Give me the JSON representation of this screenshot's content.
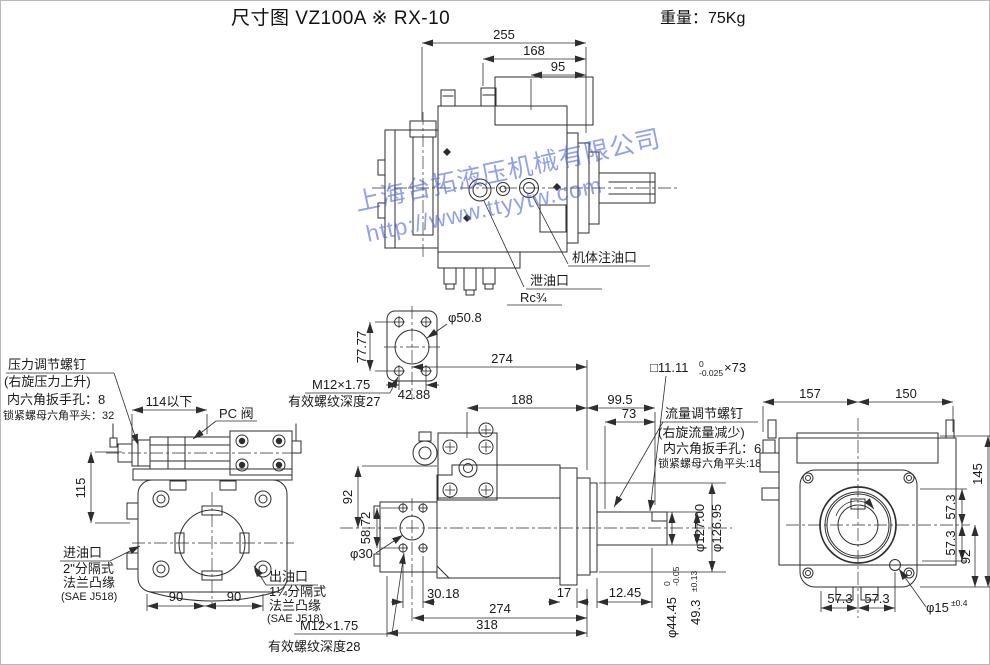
{
  "header": {
    "title": "尺寸图  VZ100A ※ RX-10",
    "weight": "重量：75Kg"
  },
  "watermark": {
    "line1": "上海台拓液压机械有限公司",
    "line2": "http://www.ttyytw.com"
  },
  "top_view": {
    "d255": "255",
    "d168": "168",
    "d95": "95",
    "fill_port": "机体注油口",
    "drain_port": "泄油口",
    "drain_thread": "Rc¾"
  },
  "pressure_screw": {
    "title": "压力调节螺钉",
    "note": "(右旋压力上升)",
    "hex_hole": "内六角扳手孔：8",
    "lock_nut": "锁紧螺母六角平头：32"
  },
  "flange_detail": {
    "d7777": "77.77",
    "dia": "φ50.8",
    "d4288": "42.88",
    "thread": "M12×1.75",
    "thread_depth": "有效螺纹深度27"
  },
  "left_view": {
    "d114": "114以下",
    "pc_valve": "PC 阀",
    "d115": "115",
    "d90a": "90",
    "d90b": "90",
    "inlet_l1": "进油口",
    "inlet_l2": "2\"分隔式",
    "inlet_l3": "法兰凸缘",
    "inlet_l4": "(SAE J518)",
    "outlet_l1": "出油口",
    "outlet_l2": "1¼分隔式",
    "outlet_l3": "法兰凸缘",
    "outlet_l4": "(SAE J518)"
  },
  "center_view": {
    "d274_top": "274",
    "d188": "188",
    "d99_5": "99.5",
    "d73": "73",
    "keyway": "□11.11",
    "keyway_hi": "0",
    "keyway_lo": "-0.025",
    "keyway_len": "×73",
    "d92": "92",
    "d58_72": "58.72",
    "dia30": "φ30",
    "d30_18": "30.18",
    "d274": "274",
    "d318": "318",
    "d17": "17",
    "d12_45": "12.45",
    "dia127_hi": "φ127.00",
    "dia127_lo": "φ126.95",
    "dia44": "φ44.45",
    "dia44_hi": "0",
    "dia44_lo": "-0.05",
    "d49_3": "49.3",
    "d49_3_tol": "±0.13",
    "thread": "M12×1.75",
    "thread_depth": "有效螺纹深度28"
  },
  "flow_screw": {
    "title": "流量调节螺钉",
    "note": "(右旋流量减少)",
    "hex_hole": "内六角扳手孔：6",
    "lock_nut": "锁紧螺母六角平头:18"
  },
  "right_view": {
    "d157": "157",
    "d150": "150",
    "d145": "145",
    "d57_3_r1": "57.3",
    "d57_3_r2": "57.3",
    "d92": "92",
    "d57_3_b1": "57.3",
    "d57_3_b2": "57.3",
    "dia15": "φ15",
    "dia15_tol": "±0.4"
  }
}
